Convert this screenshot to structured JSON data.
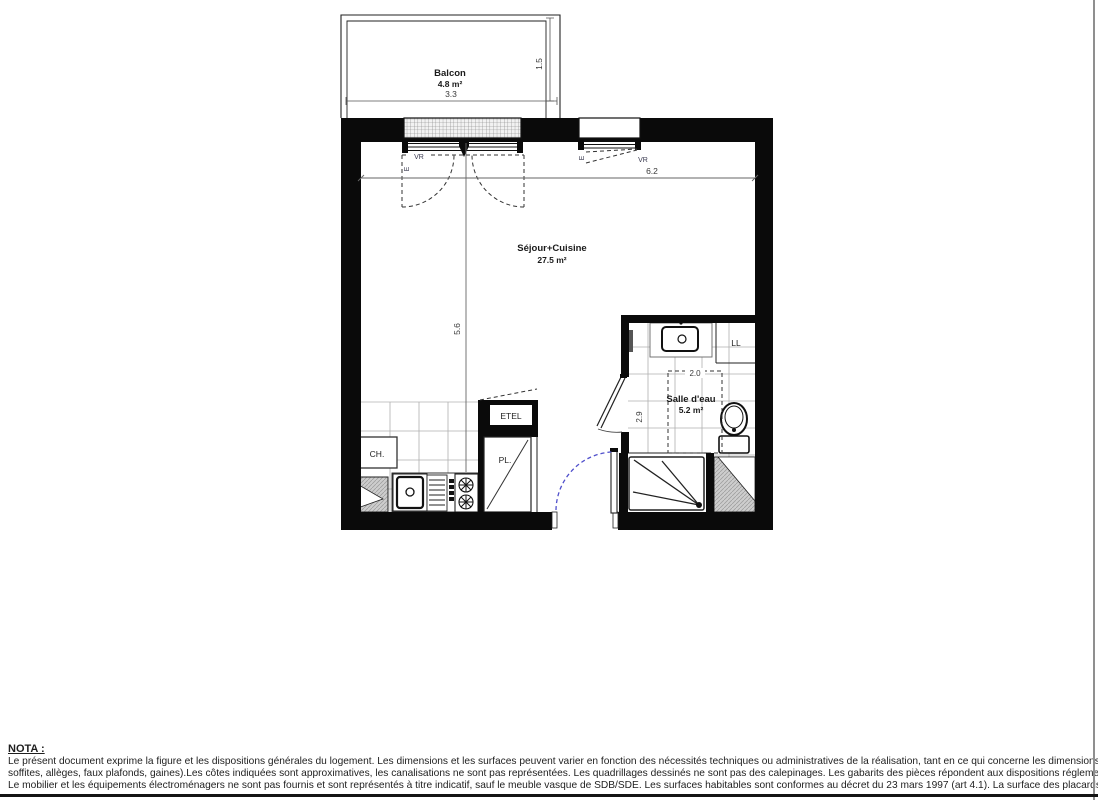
{
  "document": {
    "type": "apartment floor plan"
  },
  "rooms": {
    "balcony": {
      "label": "Balcon",
      "area": "4.8 m²"
    },
    "living_kitchen": {
      "label": "Séjour+Cuisine",
      "area": "27.5 m²"
    },
    "bathroom": {
      "label": "Salle d'eau",
      "area": "5.2 m²"
    }
  },
  "dimensions": {
    "balcony_width": "3.3",
    "balcony_depth": "1.5",
    "living_width": "6.2",
    "living_height": "5.6",
    "bathroom_width": "2.0",
    "bathroom_height": "2.9"
  },
  "labels": {
    "shutter_left": "VR",
    "air_inlet_left": "E",
    "shutter_right": "VR",
    "air_inlet_right": "E",
    "washing_machine": "LL",
    "boiler": "CH.",
    "electrical_panel": "ETEL",
    "closet": "PL."
  },
  "colors": {
    "wall": "#0a0a0a",
    "door_swing_blue": "#5050cc",
    "tile_line": "#b0b0b0"
  },
  "note": {
    "title": "NOTA :",
    "lines": [
      "Le présent document exprime la figure et les dispositions générales du logement. Les dimensions et les surfaces peuvent varier en fonction des nécessités techniques ou administratives de la réalisation, tant en ce qui concerne les dimensions libres que l'équipement (retombées de poutre,",
      "soffites, allèges, faux plafonds, gaines).Les côtes indiquées sont approximatives, les canalisations ne sont pas représentées. Les quadrillages dessinés ne sont pas des calepinages. Les gabarits des pièces répondent aux dispositions réglementaires.",
      "Le mobilier et les équipements électroménagers ne sont pas fournis et sont représentés à titre indicatif, sauf le meuble vasque de SDB/SDE. Les surfaces habitables sont conformes au décret du 23 mars 1997 (art 4.1). La surface des placards est incluse dans celle des pièces attenantes."
    ]
  }
}
